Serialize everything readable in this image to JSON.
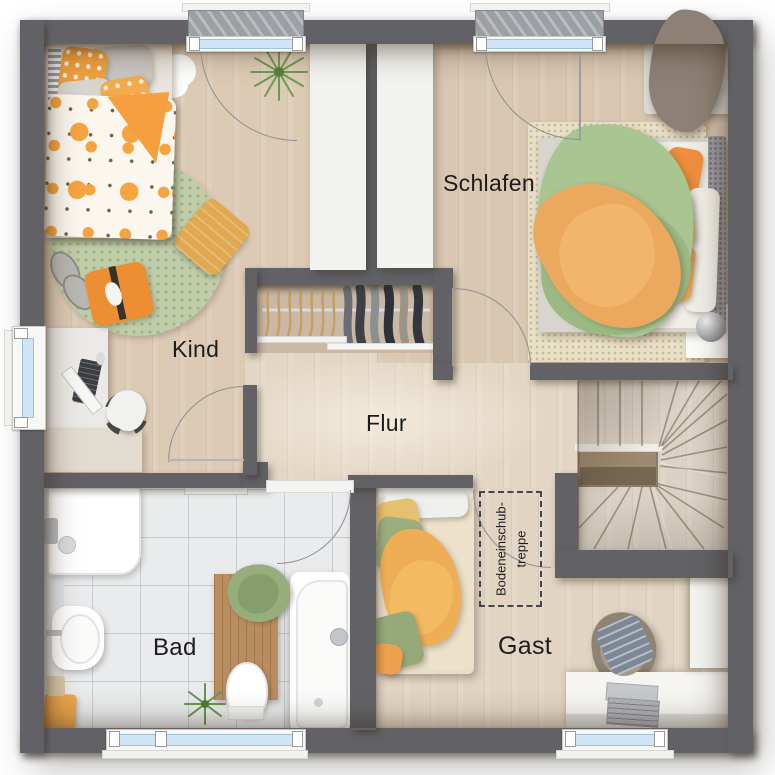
{
  "rooms": {
    "kind": {
      "label": "Kind"
    },
    "schlafen": {
      "label": "Schlafen"
    },
    "flur": {
      "label": "Flur"
    },
    "bad": {
      "label": "Bad"
    },
    "gast": {
      "label": "Gast"
    }
  },
  "annotations": {
    "attic_stairs": {
      "line1": "Bodeneinschub-",
      "line2": "treppe"
    }
  },
  "colors": {
    "wall": "#626266",
    "floor_flur": "#e3d6c4",
    "floor_kind": "#dccab5",
    "floor_schlafen": "#d9c7b1",
    "floor_closet": "#c9b8a3",
    "floor_stairs": "#dbd2c5",
    "floor_bath": "#e9ebec",
    "window_glass": "#cfe4f4",
    "accent_orange": "#f09a3e",
    "accent_green": "#a9c591",
    "rug_green": "#bfcda9",
    "rug_beige": "#e9e0c8"
  }
}
